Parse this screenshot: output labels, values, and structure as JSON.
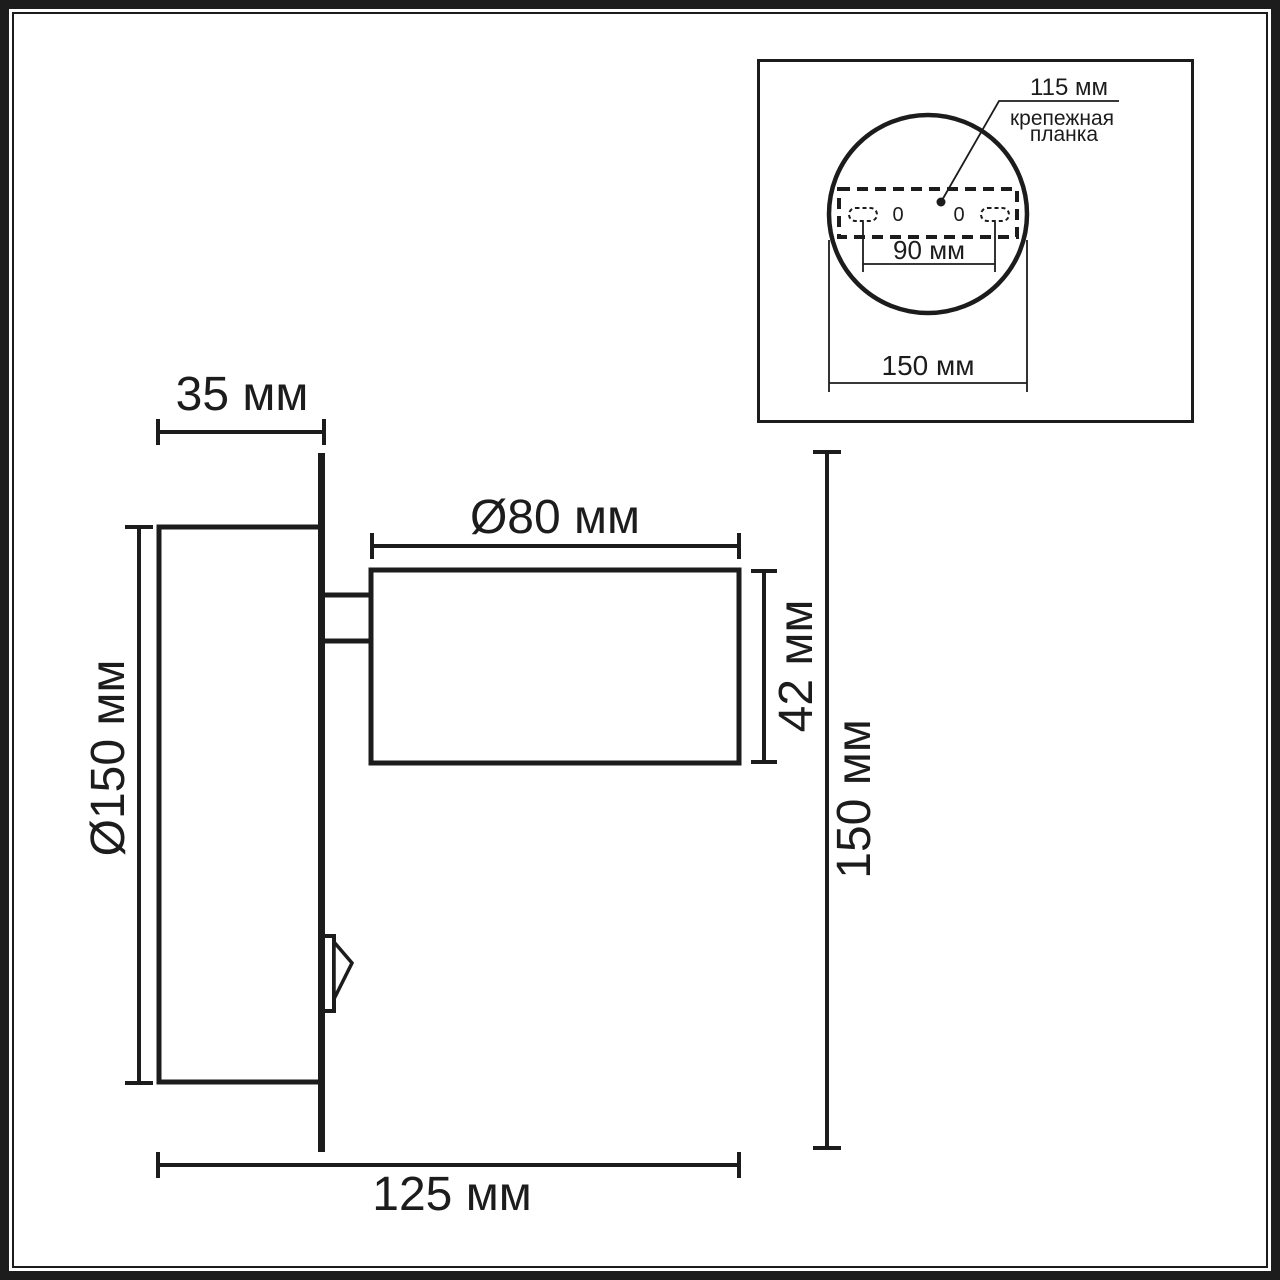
{
  "side_view": {
    "plate_depth": "35 мм",
    "head_diameter": "Ø80 мм",
    "plate_diameter": "Ø150 мм",
    "head_length": "42 мм",
    "overall_height": "150 мм",
    "overall_width": "125 мм"
  },
  "inset": {
    "bracket_width": "115 мм",
    "bracket_label_line1": "крепежная",
    "bracket_label_line2": "планка",
    "hole_spacing": "90 мм",
    "base_diameter": "150 мм",
    "hole_mark_left": "0",
    "hole_mark_right": "0"
  },
  "colors": {
    "line": "#1c1c1c",
    "background": "#ffffff"
  }
}
